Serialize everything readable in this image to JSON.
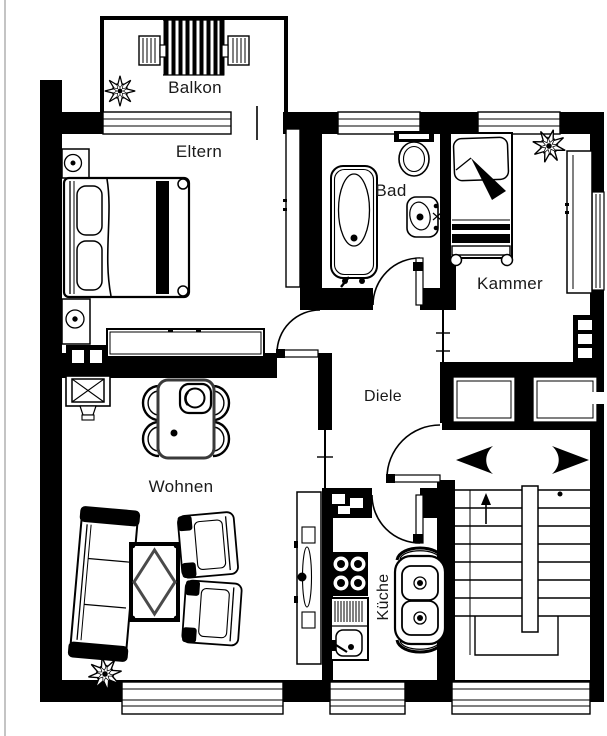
{
  "page": {
    "background": "#ffffff",
    "edge_line_color": "#c4c4c4",
    "wall_color": "#000000",
    "label_color": "#1a1a1a"
  },
  "plan": {
    "type": "apartment-floor-plan",
    "language": "de",
    "rooms": [
      {
        "id": "balkon",
        "label": "Balkon"
      },
      {
        "id": "eltern",
        "label": "Eltern"
      },
      {
        "id": "bad",
        "label": "Bad"
      },
      {
        "id": "kammer",
        "label": "Kammer"
      },
      {
        "id": "diele",
        "label": "Diele"
      },
      {
        "id": "wohnen",
        "label": "Wohnen"
      },
      {
        "id": "kueche",
        "label": "Küche"
      }
    ],
    "doors": [
      "balcony-door-opening",
      "eltern-door",
      "bad-door",
      "kammer-opening",
      "kueche-door",
      "entrance-door"
    ],
    "windows": [
      "balkon-window",
      "bad-window",
      "kammer-window-north",
      "kammer-window-east",
      "landing-glazing-left",
      "landing-glazing-right",
      "wohnen-window",
      "kueche-window",
      "stairwell-window"
    ],
    "stairwell": {
      "direction_arrows": [
        "left",
        "right"
      ],
      "up_arrow": true
    },
    "furniture": {
      "balkon": [
        "slatted-table",
        "chair",
        "chair",
        "plant"
      ],
      "eltern": [
        "nightstand-with-lamp",
        "double-bed",
        "nightstand-with-lamp",
        "tall-cabinet",
        "sideboard"
      ],
      "bad": [
        "toilet",
        "bathtub",
        "wash-basin"
      ],
      "kammer": [
        "single-bed",
        "wardrobe",
        "plant"
      ],
      "wohnen": [
        "tv-unit",
        "dining-table",
        "four-chairs",
        "fruit-bowl",
        "sofa",
        "coffee-table",
        "armchair",
        "armchair",
        "sideboard",
        "plant"
      ],
      "kueche": [
        "stove",
        "sink-counter",
        "table-for-two"
      ]
    }
  }
}
